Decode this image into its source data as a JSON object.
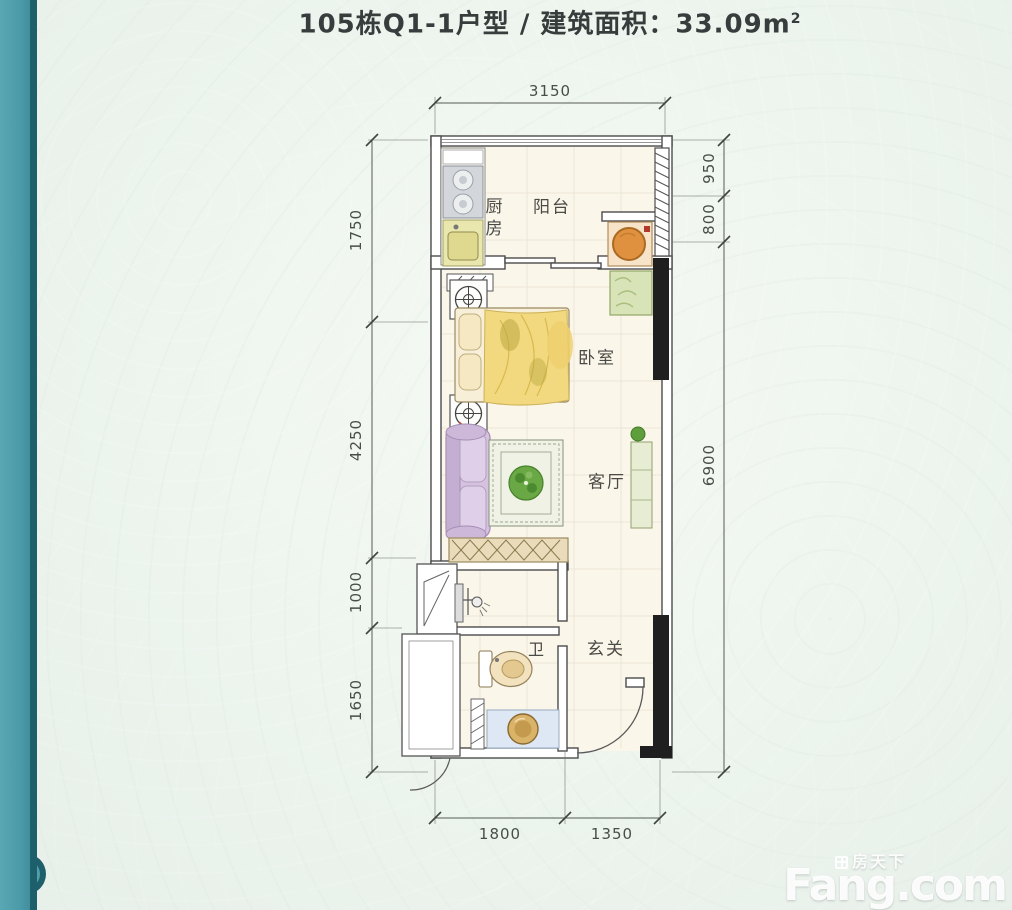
{
  "page": {
    "title_main": "105栋Q1-1户型 / 建筑面积：33.09m",
    "title_sup": "2"
  },
  "floorplan": {
    "labels": {
      "kitchen": "厨房",
      "balcony": "阳台",
      "bedroom": "卧室",
      "living_room": "客厅",
      "bathroom": "卫",
      "entry": "玄关"
    },
    "dimensions": {
      "top_width": "3150",
      "left_1": "1750",
      "left_2": "4250",
      "left_3": "1000",
      "left_4": "1650",
      "right_1": "950",
      "right_2": "800",
      "right_3": "6900",
      "bottom_1": "1800",
      "bottom_2": "1350"
    }
  },
  "watermark": {
    "brand_cn": "房天下",
    "brand_en": "Fang.com"
  },
  "colors": {
    "background": "#edf4ee",
    "accent_bar": "#4f9fad",
    "accent_bar_edge": "#1d5f6a",
    "floor": "#fbf6ea",
    "wall_outline": "#4c4c4c",
    "wall_solid": "#1f1f1f",
    "title_text": "#363d3c"
  }
}
